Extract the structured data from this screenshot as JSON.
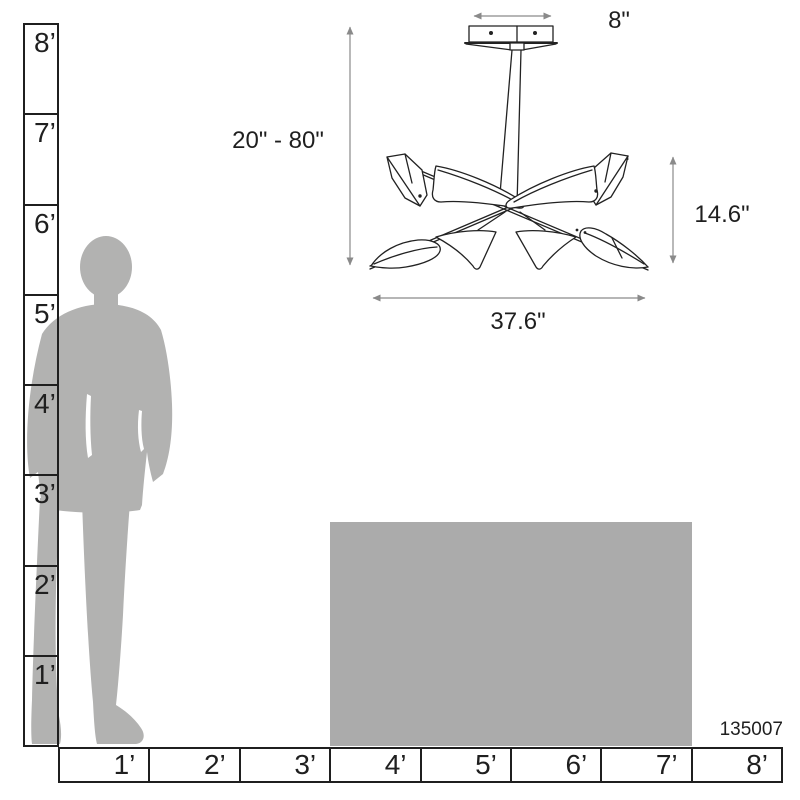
{
  "diagram": {
    "product_number": "135007",
    "dimensions": {
      "canopy_width": "8\"",
      "drop_range": "20\" - 80\"",
      "fixture_height": "14.6\"",
      "fixture_width": "37.6\""
    }
  },
  "rulers": {
    "vertical_feet": {
      "labels": [
        "8’",
        "7’",
        "6’",
        "5’",
        "4’",
        "3’",
        "2’",
        "1’"
      ]
    },
    "horizontal_feet": {
      "labels": [
        "1’",
        "2’",
        "3’",
        "4’",
        "5’",
        "6’",
        "7’",
        "8’"
      ]
    }
  },
  "graphics": {
    "man_silhouette": "standing-man-silhouette",
    "furniture_block": "table-scale-block",
    "fixture_drawing": "quill-chandelier-line-drawing"
  },
  "colors": {
    "silhouette_gray": "#b2b2b1",
    "furniture_gray": "#ababab",
    "line_black": "#1f1f1f",
    "dimension_gray": "#8a8a8a"
  }
}
